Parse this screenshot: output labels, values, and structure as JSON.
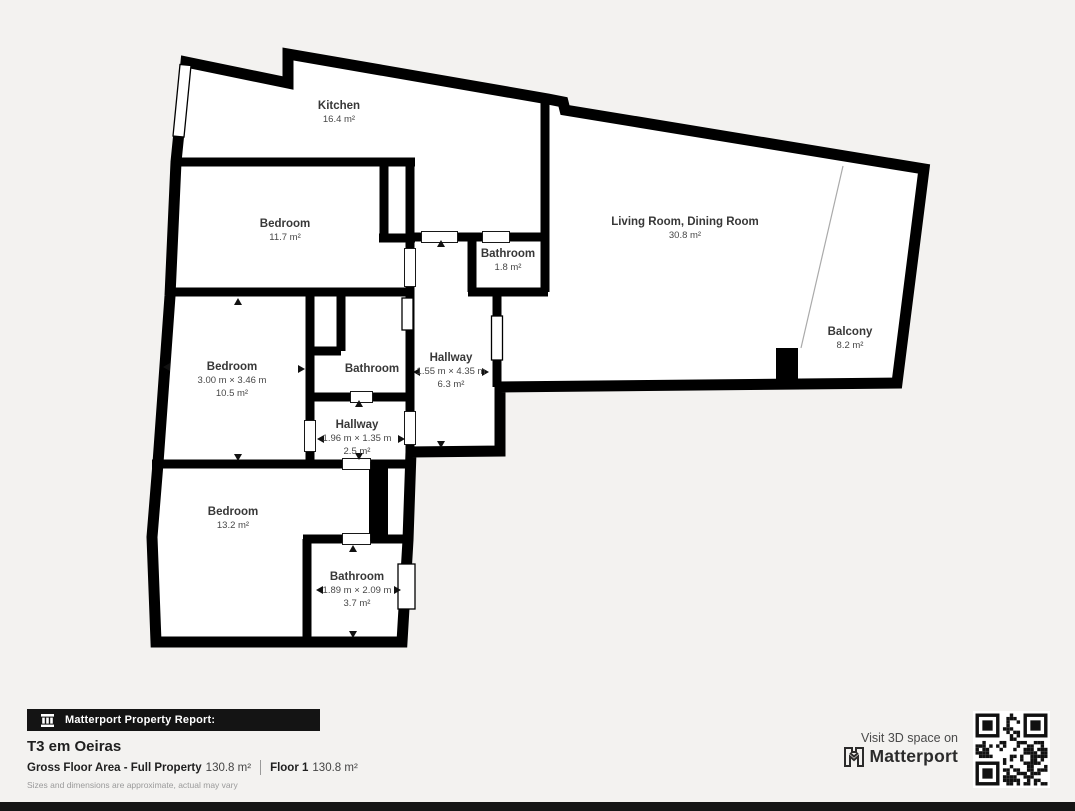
{
  "rooms": [
    {
      "name": "Kitchen",
      "area": "16.4 m²"
    },
    {
      "name": "Bedroom",
      "area": "11.7 m²"
    },
    {
      "name": "Living Room, Dining Room",
      "area": "30.8 m²"
    },
    {
      "name": "Balcony",
      "area": "8.2 m²"
    },
    {
      "name": "Bathroom",
      "area": "1.8 m²"
    },
    {
      "name": "Bedroom",
      "dims": "3.00 m × 3.46 m",
      "area": "10.5 m²"
    },
    {
      "name": "Bathroom"
    },
    {
      "name": "Hallway",
      "dims": "1.55 m × 4.35 m",
      "area": "6.3 m²"
    },
    {
      "name": "Hallway",
      "dims": "1.96 m × 1.35 m",
      "area": "2.5 m²"
    },
    {
      "name": "Bedroom",
      "area": "13.2 m²"
    },
    {
      "name": "Bathroom",
      "dims": "1.89 m × 2.09 m",
      "area": "3.7 m²"
    }
  ],
  "footer": {
    "report_label": "Matterport Property Report:",
    "property_name": "T3 em Oeiras",
    "gross_label": "Gross Floor Area - Full Property",
    "gross_value": "130.8 m²",
    "floor_label": "Floor 1",
    "floor_value": "130.8 m²",
    "disclaimer": "Sizes and dimensions are approximate, actual may vary"
  },
  "cta": {
    "visit_text": "Visit 3D space on",
    "brand": "Matterport"
  },
  "icons": {
    "bar_icon": "building-icon",
    "brand_icon": "matterport-logo-icon",
    "qr": "qr-code"
  },
  "colors": {
    "background": "#f3f2f0",
    "wall": "#000000",
    "room_fill": "#ffffff",
    "label_text": "#3b3b3b",
    "footer_bar": "#141414",
    "bottom_bar": "#151515"
  }
}
